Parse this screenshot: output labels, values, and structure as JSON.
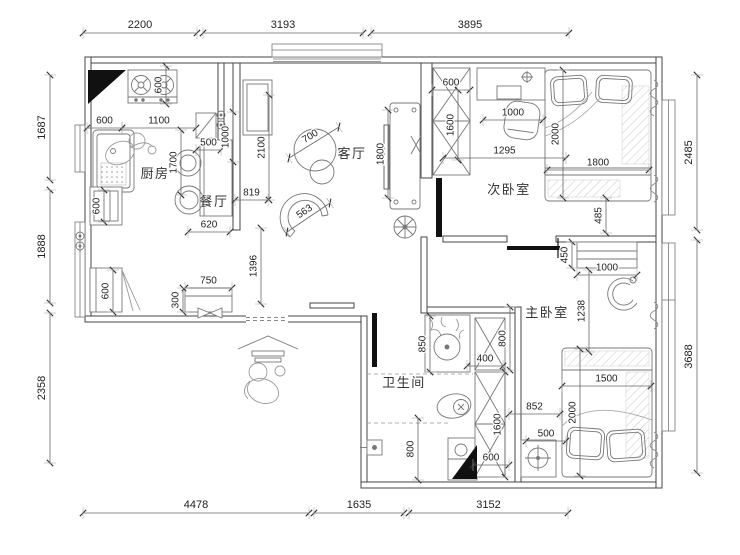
{
  "canvas": {
    "width": 740,
    "height": 555,
    "background": "#ffffff"
  },
  "colors": {
    "wall_line": "#444444",
    "furniture_line": "#777777",
    "dim_line": "#666666",
    "tick_color": "#333333",
    "dim_text": "#222222",
    "room_text": "#333333",
    "solid_fill": "#111111",
    "hatch_color": "#c8c8c8"
  },
  "rooms": [
    {
      "id": "kitchen",
      "label": "厨房",
      "x": 155,
      "y": 172
    },
    {
      "id": "dining",
      "label": "餐厅",
      "x": 214,
      "y": 200
    },
    {
      "id": "living",
      "label": "客厅",
      "x": 352,
      "y": 152
    },
    {
      "id": "bedroom-2",
      "label": "次卧室",
      "x": 509,
      "y": 188
    },
    {
      "id": "bedroom-master",
      "label": "主卧室",
      "x": 547,
      "y": 311
    },
    {
      "id": "bathroom",
      "label": "卫生间",
      "x": 404,
      "y": 381
    }
  ],
  "dimensions": {
    "outer": [
      {
        "v": "2200",
        "x1": 83,
        "y1": 33,
        "x2": 197,
        "y2": 33
      },
      {
        "v": "3193",
        "x1": 203,
        "y1": 33,
        "x2": 363,
        "y2": 33
      },
      {
        "v": "3895",
        "x1": 371,
        "y1": 33,
        "x2": 569,
        "y2": 33
      },
      {
        "v": "1687",
        "x1": 50,
        "y1": 180,
        "x2": 50,
        "y2": 75
      },
      {
        "v": "1888",
        "x1": 50,
        "y1": 303,
        "x2": 50,
        "y2": 190
      },
      {
        "v": "2358",
        "x1": 50,
        "y1": 463,
        "x2": 50,
        "y2": 313
      },
      {
        "v": "2485",
        "x1": 697,
        "y1": 230,
        "x2": 697,
        "y2": 75
      },
      {
        "v": "3688",
        "x1": 697,
        "y1": 473,
        "x2": 697,
        "y2": 240
      },
      {
        "v": "4478",
        "x1": 83,
        "y1": 513,
        "x2": 309,
        "y2": 513
      },
      {
        "v": "1635",
        "x1": 314,
        "y1": 513,
        "x2": 404,
        "y2": 513
      },
      {
        "v": "3152",
        "x1": 409,
        "y1": 513,
        "x2": 568,
        "y2": 513
      }
    ],
    "inner": [
      {
        "v": "600",
        "x1": 166,
        "y1": 104,
        "x2": 166,
        "y2": 66
      },
      {
        "v": "600",
        "x1": 87,
        "y1": 128,
        "x2": 122,
        "y2": 128
      },
      {
        "v": "1100",
        "x1": 122,
        "y1": 128,
        "x2": 196,
        "y2": 128
      },
      {
        "v": "500",
        "x1": 196,
        "y1": 150,
        "x2": 221,
        "y2": 150
      },
      {
        "v": "1000",
        "x1": 233,
        "y1": 162,
        "x2": 233,
        "y2": 112
      },
      {
        "v": "1700",
        "x1": 181,
        "y1": 195,
        "x2": 181,
        "y2": 130
      },
      {
        "v": "2100",
        "x1": 269,
        "y1": 200,
        "x2": 269,
        "y2": 95
      },
      {
        "v": "819",
        "x1": 235,
        "y1": 200,
        "x2": 268,
        "y2": 200
      },
      {
        "v": "620",
        "x1": 188,
        "y1": 232,
        "x2": 230,
        "y2": 232
      },
      {
        "v": "700",
        "x1": 289,
        "y1": 158,
        "x2": 339,
        "y2": 127
      },
      {
        "v": "563",
        "x1": 287,
        "y1": 232,
        "x2": 330,
        "y2": 203
      },
      {
        "v": "1800",
        "x1": 388,
        "y1": 198,
        "x2": 388,
        "y2": 110
      },
      {
        "v": "1396",
        "x1": 261,
        "y1": 304,
        "x2": 261,
        "y2": 228
      },
      {
        "v": "750",
        "x1": 185,
        "y1": 288,
        "x2": 232,
        "y2": 288
      },
      {
        "v": "300",
        "x1": 183,
        "y1": 312,
        "x2": 183,
        "y2": 288
      },
      {
        "v": "600",
        "x1": 113,
        "y1": 312,
        "x2": 113,
        "y2": 270
      },
      {
        "v": "600",
        "x1": 104,
        "y1": 222,
        "x2": 104,
        "y2": 190
      },
      {
        "v": "600",
        "x1": 432,
        "y1": 90,
        "x2": 470,
        "y2": 90
      },
      {
        "v": "1600",
        "x1": 458,
        "y1": 160,
        "x2": 458,
        "y2": 90
      },
      {
        "v": "1000",
        "x1": 483,
        "y1": 120,
        "x2": 543,
        "y2": 120
      },
      {
        "v": "1295",
        "x1": 443,
        "y1": 158,
        "x2": 566,
        "y2": 158
      },
      {
        "v": "2000",
        "x1": 563,
        "y1": 198,
        "x2": 563,
        "y2": 70
      },
      {
        "v": "1800",
        "x1": 547,
        "y1": 170,
        "x2": 649,
        "y2": 170
      },
      {
        "v": "485",
        "x1": 606,
        "y1": 233,
        "x2": 606,
        "y2": 198
      },
      {
        "v": "450",
        "x1": 572,
        "y1": 268,
        "x2": 572,
        "y2": 242
      },
      {
        "v": "1000",
        "x1": 577,
        "y1": 275,
        "x2": 637,
        "y2": 275
      },
      {
        "v": "1238",
        "x1": 589,
        "y1": 352,
        "x2": 589,
        "y2": 270
      },
      {
        "v": "852",
        "x1": 509,
        "y1": 414,
        "x2": 560,
        "y2": 414
      },
      {
        "v": "500",
        "x1": 526,
        "y1": 441,
        "x2": 566,
        "y2": 441
      },
      {
        "v": "2000",
        "x1": 580,
        "y1": 476,
        "x2": 580,
        "y2": 349
      },
      {
        "v": "1500",
        "x1": 562,
        "y1": 386,
        "x2": 651,
        "y2": 386
      },
      {
        "v": "850",
        "x1": 430,
        "y1": 372,
        "x2": 430,
        "y2": 316
      },
      {
        "v": "400",
        "x1": 467,
        "y1": 366,
        "x2": 503,
        "y2": 366
      },
      {
        "v": "800",
        "x1": 510,
        "y1": 370,
        "x2": 510,
        "y2": 307
      },
      {
        "v": "1600",
        "x1": 505,
        "y1": 477,
        "x2": 505,
        "y2": 372
      },
      {
        "v": "600",
        "x1": 473,
        "y1": 465,
        "x2": 509,
        "y2": 465
      },
      {
        "v": "800",
        "x1": 418,
        "y1": 480,
        "x2": 418,
        "y2": 418
      }
    ]
  },
  "icons": [
    "gas-stove-icon",
    "kitchen-sink-icon",
    "radiator-icon",
    "shoe-cabinet-icon",
    "dining-table-icon",
    "dining-chair-icon",
    "round-table-icon",
    "curved-sofa-icon",
    "tv-cabinet-icon",
    "ceiling-fan-icon",
    "entry-canopy-icon",
    "person-icon",
    "wardrobe-icon",
    "desk-icon",
    "desk-chair-icon",
    "double-bed-icon",
    "dresser-icon",
    "armchair-icon",
    "nightstand-lamp-icon",
    "washbasin-icon",
    "toilet-icon",
    "shower-icon",
    "washing-machine-icon",
    "curtain-icon",
    "window-icon",
    "door-leaf-icon"
  ]
}
